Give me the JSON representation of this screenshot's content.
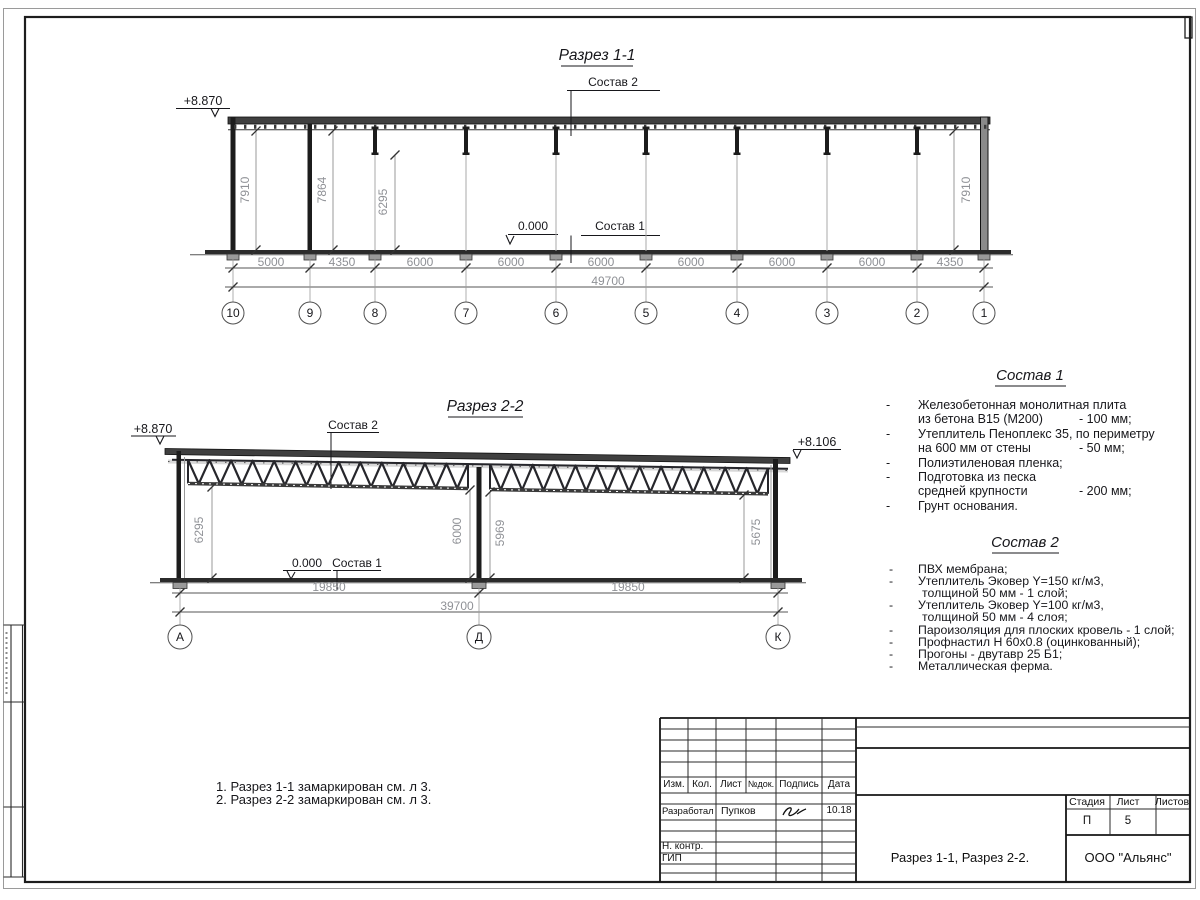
{
  "bullet": "-",
  "section1": {
    "title": "Разрез 1-1",
    "elevation_left": "+8.870",
    "label_layers_roof": "Состав 2",
    "label_zero": "0.000",
    "label_layers_floor": "Состав 1",
    "vdims": [
      "7910",
      "7864",
      "6295",
      "7910"
    ],
    "dims": [
      "5000",
      "4350",
      "6000",
      "6000",
      "6000",
      "6000",
      "6000",
      "6000",
      "4350"
    ],
    "total": "49700",
    "grids": [
      "10",
      "9",
      "8",
      "7",
      "6",
      "5",
      "4",
      "3",
      "2",
      "1"
    ]
  },
  "section2": {
    "title": "Разрез 2-2",
    "elevation_left": "+8.870",
    "elevation_right": "+8.106",
    "label_layers_roof": "Состав 2",
    "label_zero": "0.000",
    "label_layers_floor": "Состав 1",
    "vdims": [
      "6295",
      "6000",
      "5969",
      "5675"
    ],
    "dims": [
      "19850",
      "19850"
    ],
    "total": "39700",
    "grids": [
      "А",
      "Д",
      "К"
    ]
  },
  "layers1": {
    "title": "Состав 1",
    "items": [
      {
        "lines": [
          "Железобетонная монолитная плита",
          "из бетона В15 (М200)"
        ],
        "value": "- 100 мм;"
      },
      {
        "lines": [
          "Утеплитель Пеноплекс 35, по периметру",
          "на 600 мм от стены"
        ],
        "value": "- 50 мм;"
      },
      {
        "lines": [
          "Полиэтиленовая пленка;"
        ],
        "value": ""
      },
      {
        "lines": [
          "Подготовка из песка",
          "средней крупности"
        ],
        "value": "- 200 мм;"
      },
      {
        "lines": [
          "Грунт основания."
        ],
        "value": ""
      }
    ]
  },
  "layers2": {
    "title": "Состав 2",
    "items": [
      {
        "lines": [
          "ПВХ мембрана;"
        ]
      },
      {
        "lines": [
          "Утеплитель Эковер Y=150 кг/м3,",
          "толщиной 50 мм - 1 слой;"
        ]
      },
      {
        "lines": [
          "Утеплитель Эковер Y=100 кг/м3,",
          "толщиной 50 мм - 4 слоя;"
        ]
      },
      {
        "lines": [
          "Пароизоляция для плоских кровель - 1 слой;"
        ]
      },
      {
        "lines": [
          "Профнастил Н 60х0.8 (оцинкованный);"
        ]
      },
      {
        "lines": [
          "Прогоны - двутавр 25 Б1;"
        ]
      },
      {
        "lines": [
          "Металлическая ферма."
        ]
      }
    ]
  },
  "notes": [
    "1. Разрез 1-1 замаркирован см. л 3.",
    "2. Разрез 2-2 замаркирован см. л 3."
  ],
  "stamp": {
    "cols": [
      "Изм.",
      "Кол.",
      "Лист",
      "№док.",
      "Подпись",
      "Дата"
    ],
    "developed_label": "Разработал",
    "developed_name": "Пупков",
    "date": "10.18",
    "ncontr_label": "Н. контр.",
    "gip_label": "ГИП",
    "stage_label": "Стадия",
    "sheet_label": "Лист",
    "sheets_label": "Листов",
    "stage": "П",
    "sheet_no": "5",
    "doc_title": "Разрез 1-1, Разрез 2-2.",
    "company": "ООО \"Альянс\""
  }
}
